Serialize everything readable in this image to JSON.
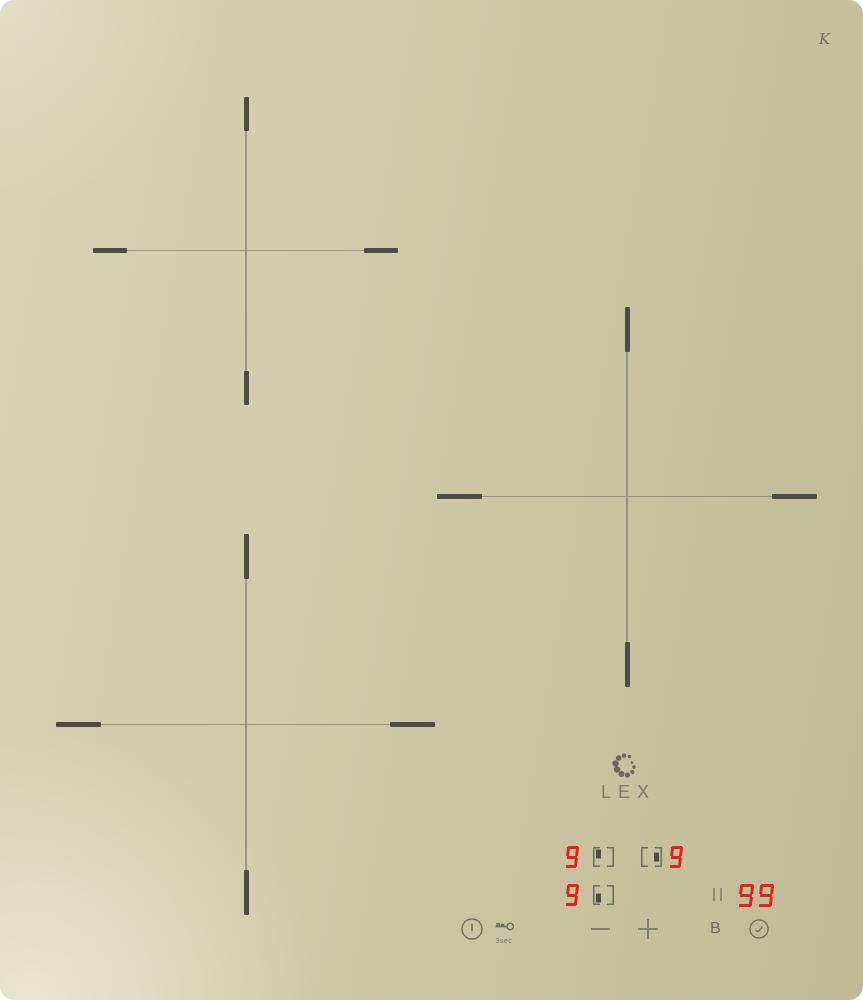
{
  "panel": {
    "brand": "LEX",
    "glass_mark": "K"
  },
  "display": {
    "zone_top_left": {
      "power": "9",
      "position": "top-left"
    },
    "zone_right": {
      "power": "9",
      "position": "right"
    },
    "zone_bottom_left": {
      "power": "9",
      "position": "bottom-left"
    },
    "timer": {
      "value": "99",
      "separator": "||"
    }
  },
  "controls": {
    "lock_label": "3sec",
    "boost_label": "B"
  },
  "colors": {
    "glass_beige": "#cdc6a6",
    "digit_red": "#e2231a",
    "control_gray": "#6f6c5d",
    "cross_tick": "#4e4d45",
    "cross_line": "#8f8b7b"
  }
}
